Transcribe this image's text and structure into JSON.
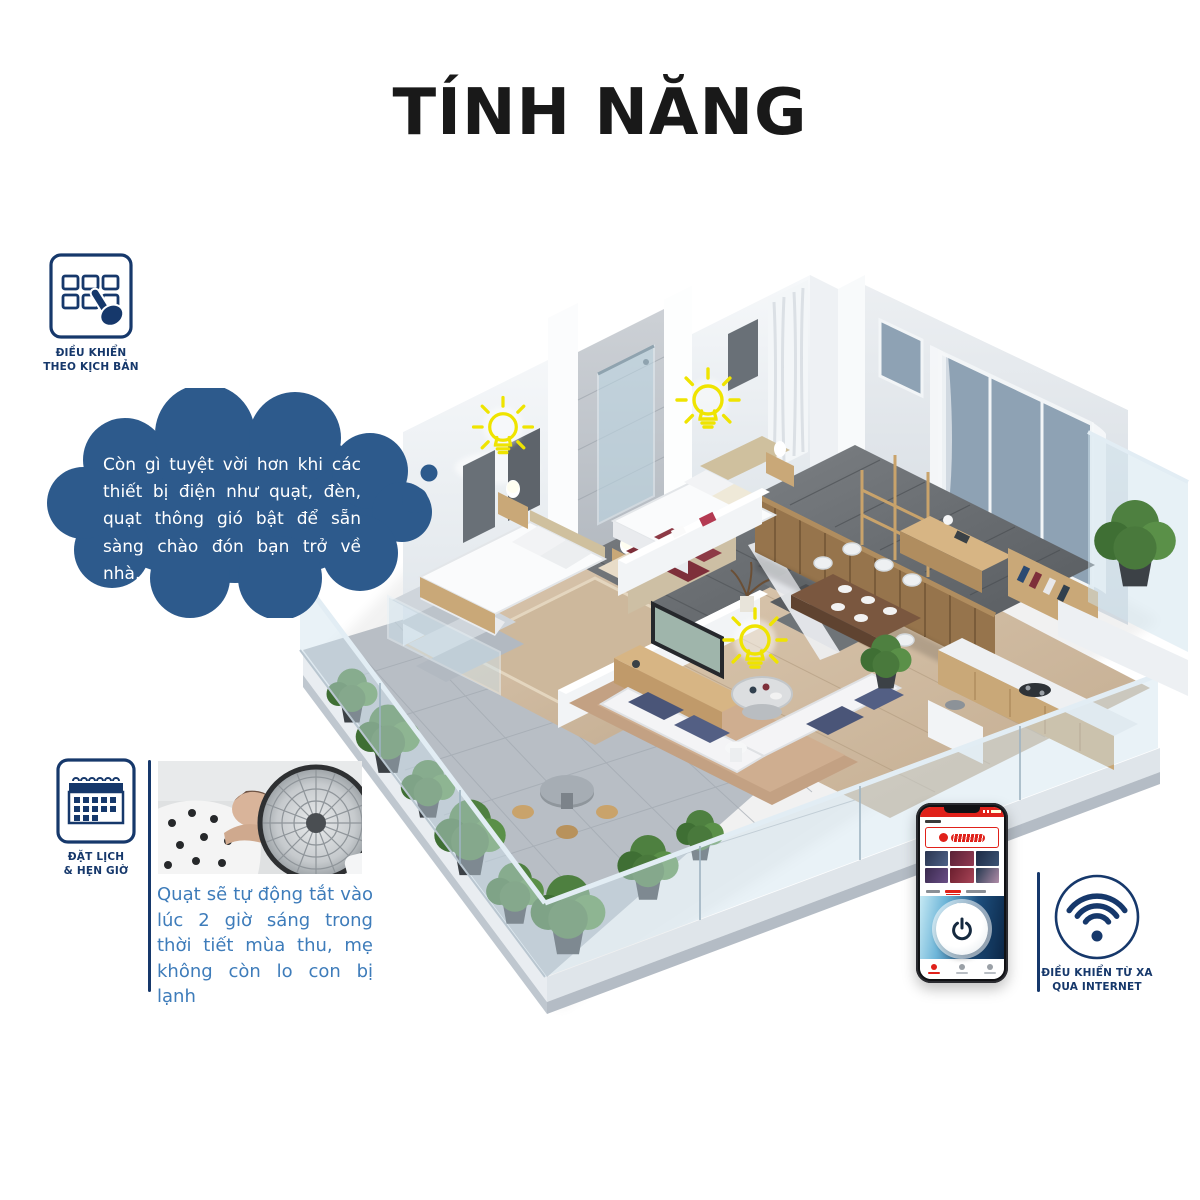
{
  "title": "TÍNH NĂNG",
  "features": {
    "scenario": {
      "icon": "grid-tap-icon",
      "label_line1": "ĐIỀU KHIỂN",
      "label_line2": "THEO KỊCH BẢN",
      "thought_text": "Còn gì tuyệt vời hơn khi các thiết bị điện như quạt, đèn, quạt thông gió bật để sẵn sàng chào đón bạn trở về nhà."
    },
    "schedule": {
      "icon": "calendar-icon",
      "label_line1": "ĐẶT LỊCH",
      "label_line2": "& HẸN GIỜ",
      "caption": "Quạt sẽ tự động tắt vào lúc 2 giờ sáng trong thời tiết mùa thu, mẹ không còn lo con bị lạnh",
      "photo": "child-sleeping-beside-standing-fan"
    },
    "remote": {
      "icon": "wifi-icon",
      "label_line1": "ĐIỀU KHIỂN TỪ XA",
      "label_line2": "QUA INTERNET"
    }
  },
  "phone_app": {
    "power_state_label": "on"
  },
  "illustration": {
    "type": "isometric-smart-home-cutaway",
    "light_bulbs": 3
  },
  "colors": {
    "navy": "#16386b",
    "bubble_blue": "#2d5a8c",
    "caption_blue": "#3e7cba",
    "bulb_yellow": "#efe400",
    "app_red": "#e0211a",
    "title_black": "#191919"
  }
}
